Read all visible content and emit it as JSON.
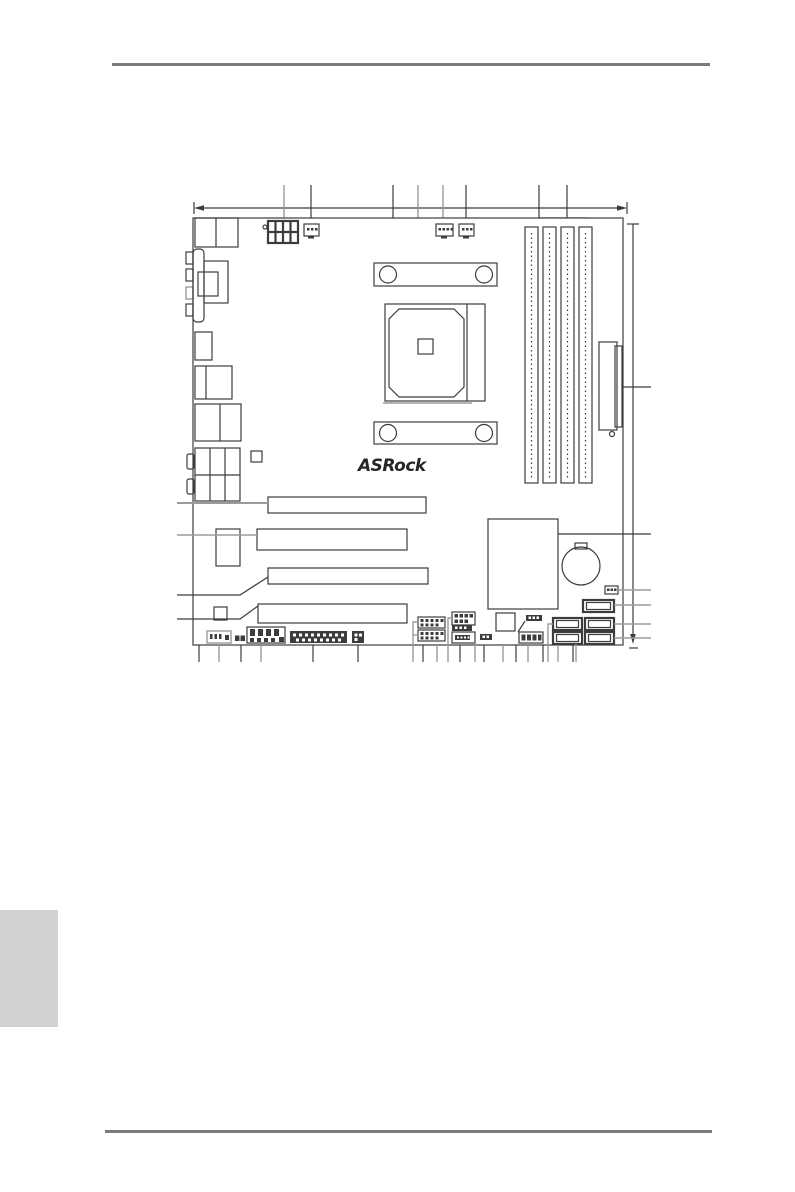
{
  "page": {
    "kind": "motherboard-manual-layout-page",
    "visible_text": [
      "ASRock"
    ]
  },
  "logo": {
    "text": "ASRock"
  },
  "colors": {
    "background": "#ffffff",
    "diagram_line": "#3c3c3c",
    "callout_gray": "#9b9b9b",
    "page_rule": "#7a7a7a",
    "side_tab": "#d2d2d2"
  },
  "diagram": {
    "subject": "motherboard-layout-diagram",
    "components": [
      "atx-12v-power-connector",
      "cpu-fan-connector",
      "chassis-fan-connector",
      "power-fan-connector",
      "cpu-socket",
      "cpu-retention-bracket-top",
      "cpu-retention-bracket-bottom",
      "dimm-slot-1",
      "dimm-slot-2",
      "dimm-slot-3",
      "dimm-slot-4",
      "atx-24pin-power-connector",
      "rear-io-ports",
      "vga-d-sub-port",
      "pcie-x16-slot-1",
      "pci-slot-1",
      "pcie-x16-slot-2",
      "pci-slot-2",
      "southbridge-chip",
      "cmos-battery",
      "sata-connector-x5",
      "usb-header-x2",
      "front-panel-header",
      "com-port-header",
      "audio-header",
      "system-panel-header",
      "spdif-header",
      "clear-cmos-jumper",
      "bios-chip",
      "board-dimension-lines",
      "callout-leader-lines"
    ]
  }
}
